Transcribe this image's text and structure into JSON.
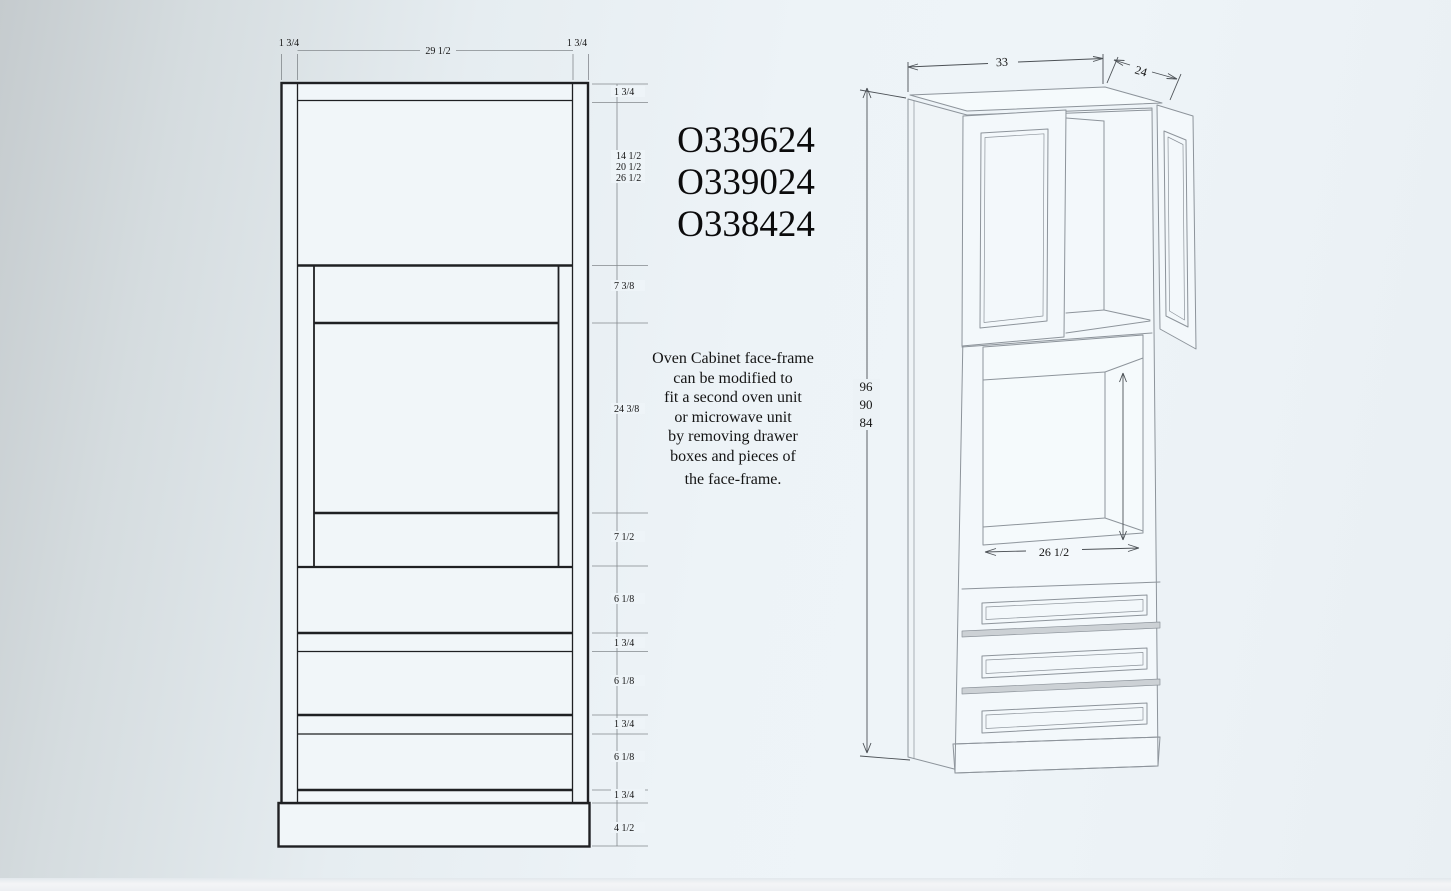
{
  "title_models": {
    "m1": "O339624",
    "m2": "O339024",
    "m3": "O338424"
  },
  "note": {
    "l1": "Oven Cabinet face-frame",
    "l2": "can be modified to",
    "l3": "fit a second oven unit",
    "l4": "or microwave unit",
    "l5": "by removing drawer",
    "l6": "boxes and pieces of",
    "l7": "the face-frame."
  },
  "front_view": {
    "stile_left": "1 3/4",
    "opening_width": "29 1/2",
    "stile_right": "1 3/4",
    "top_rail": "1 3/4",
    "door_opening_heights": {
      "h96": "14 1/2",
      "h90": "20 1/2",
      "h84": "26 1/2"
    },
    "oven_top_rail": "7 3/8",
    "oven_opening_height": "24 3/8",
    "oven_bottom_rail": "7 1/2",
    "drawer1": "6 1/8",
    "rail1": "1 3/4",
    "drawer2": "6 1/8",
    "rail2": "1 3/4",
    "drawer3": "6 1/8",
    "bottom_rail": "1 3/4",
    "toe_kick": "4 1/2"
  },
  "iso_view": {
    "width": "33",
    "depth": "24",
    "heights": {
      "h1": "96",
      "h2": "90",
      "h3": "84"
    },
    "oven_opening_width": "26 1/2"
  }
}
